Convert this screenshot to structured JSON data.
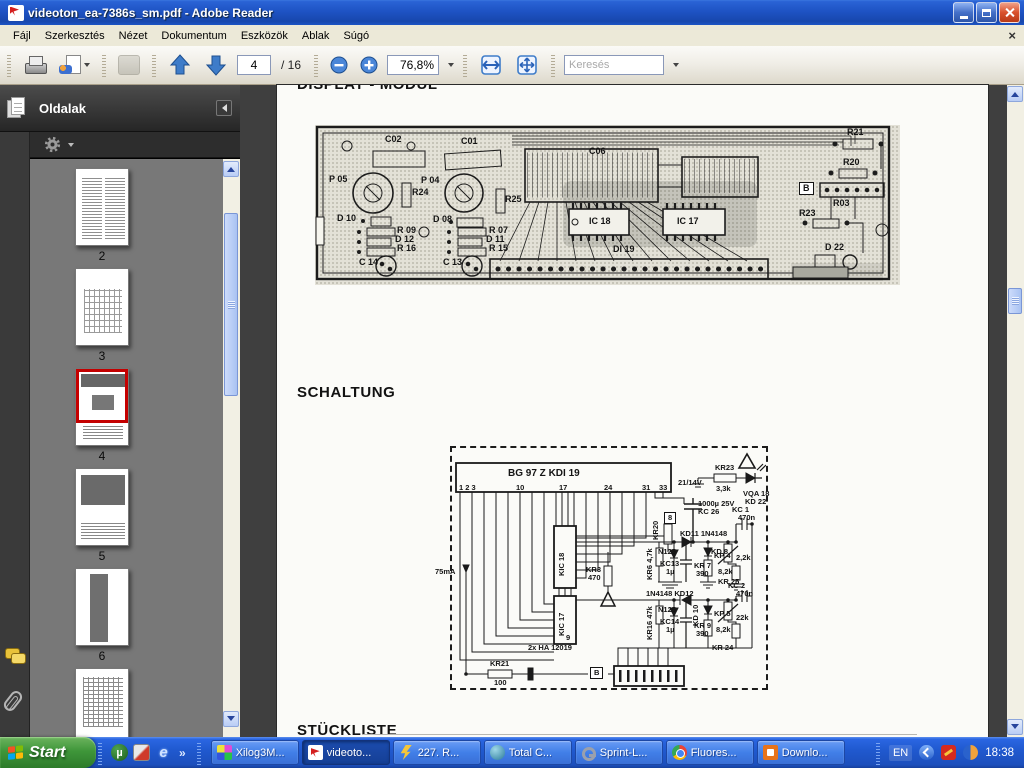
{
  "window": {
    "title": "videoton_ea-7386s_sm.pdf - Adobe Reader"
  },
  "menubar": {
    "items": [
      "Fájl",
      "Szerkesztés",
      "Nézet",
      "Dokumentum",
      "Eszközök",
      "Ablak",
      "Súgó"
    ],
    "close_label": "×"
  },
  "toolbar": {
    "page_current": "4",
    "page_total": "/ 16",
    "zoom_value": "76,8%",
    "search_placeholder": "Keresés"
  },
  "sidebar": {
    "title": "Oldalak",
    "pages": [
      {
        "label": "2",
        "kind": "text"
      },
      {
        "label": "3",
        "kind": "diagram"
      },
      {
        "label": "4",
        "kind": "pcb",
        "selected": true
      },
      {
        "label": "5",
        "kind": "schem"
      },
      {
        "label": "6",
        "kind": "tall"
      },
      {
        "label": "",
        "kind": "schem2",
        "partial": true
      }
    ]
  },
  "page": {
    "heading_top": "DISPLAY - MODUL",
    "heading_schaltung": "SCHALTUNG",
    "heading_stueckliste": "STÜCKLISTE"
  },
  "pcb": {
    "labels": [
      {
        "t": "C02",
        "x": 70,
        "y": 10
      },
      {
        "t": "C01",
        "x": 146,
        "y": 12
      },
      {
        "t": "C06",
        "x": 274,
        "y": 22
      },
      {
        "t": "P 05",
        "x": 14,
        "y": 50
      },
      {
        "t": "P 04",
        "x": 106,
        "y": 51
      },
      {
        "t": "R24",
        "x": 97,
        "y": 63
      },
      {
        "t": "R25",
        "x": 190,
        "y": 70
      },
      {
        "t": "D 10",
        "x": 22,
        "y": 89
      },
      {
        "t": "D 08",
        "x": 118,
        "y": 90
      },
      {
        "t": "R 09",
        "x": 82,
        "y": 101
      },
      {
        "t": "R 07",
        "x": 174,
        "y": 101
      },
      {
        "t": "D 12",
        "x": 80,
        "y": 110
      },
      {
        "t": "D 11",
        "x": 171,
        "y": 110
      },
      {
        "t": "R 16",
        "x": 82,
        "y": 119
      },
      {
        "t": "R 15",
        "x": 174,
        "y": 119
      },
      {
        "t": "C 14",
        "x": 44,
        "y": 133
      },
      {
        "t": "C 13",
        "x": 128,
        "y": 133
      },
      {
        "t": "IC 18",
        "x": 274,
        "y": 92
      },
      {
        "t": "IC 17",
        "x": 362,
        "y": 92
      },
      {
        "t": "DI 19",
        "x": 298,
        "y": 120
      },
      {
        "t": "R21",
        "x": 532,
        "y": 3
      },
      {
        "t": "R20",
        "x": 528,
        "y": 33
      },
      {
        "t": "R03",
        "x": 518,
        "y": 74
      },
      {
        "t": "R23",
        "x": 484,
        "y": 84
      },
      {
        "t": "D 22",
        "x": 510,
        "y": 118
      },
      {
        "t": "B",
        "x": 484,
        "y": 57,
        "box": true
      }
    ]
  },
  "schematic": {
    "labels": [
      {
        "t": "BG 97 Z   KDI 19",
        "x": 56,
        "y": 21,
        "fs": 10
      },
      {
        "t": "1 2 3",
        "x": 7,
        "y": 36
      },
      {
        "t": "10",
        "x": 64,
        "y": 36
      },
      {
        "t": "17",
        "x": 107,
        "y": 36
      },
      {
        "t": "24",
        "x": 152,
        "y": 36
      },
      {
        "t": "31",
        "x": 190,
        "y": 36
      },
      {
        "t": "33",
        "x": 207,
        "y": 36
      },
      {
        "t": "21/14V",
        "x": 226,
        "y": 31
      },
      {
        "t": "KR23",
        "x": 263,
        "y": 16
      },
      {
        "t": "3,3k",
        "x": 264,
        "y": 37
      },
      {
        "t": "VQA 18",
        "x": 291,
        "y": 42
      },
      {
        "t": "KD 22",
        "x": 293,
        "y": 50
      },
      {
        "t": "1000µ 25V",
        "x": 246,
        "y": 52
      },
      {
        "t": "KC 26",
        "x": 246,
        "y": 60
      },
      {
        "t": "KC 1",
        "x": 280,
        "y": 58
      },
      {
        "t": "470n",
        "x": 286,
        "y": 66
      },
      {
        "t": "KD11 1N4148",
        "x": 228,
        "y": 82
      },
      {
        "t": "N125",
        "x": 206,
        "y": 100
      },
      {
        "t": "KD 8",
        "x": 259,
        "y": 100
      },
      {
        "t": "KP 4",
        "x": 262,
        "y": 104
      },
      {
        "t": "2,2k",
        "x": 284,
        "y": 106
      },
      {
        "t": "KR 7",
        "x": 242,
        "y": 114
      },
      {
        "t": "390",
        "x": 244,
        "y": 122
      },
      {
        "t": "KC13",
        "x": 208,
        "y": 112
      },
      {
        "t": "1µ",
        "x": 214,
        "y": 120
      },
      {
        "t": "8,2k",
        "x": 266,
        "y": 120
      },
      {
        "t": "KR 25",
        "x": 266,
        "y": 130
      },
      {
        "t": "KR3",
        "x": 134,
        "y": 118
      },
      {
        "t": "470",
        "x": 136,
        "y": 126
      },
      {
        "t": "1N4148 KD12",
        "x": 194,
        "y": 142
      },
      {
        "t": "N125",
        "x": 206,
        "y": 158
      },
      {
        "t": "KC14",
        "x": 208,
        "y": 170
      },
      {
        "t": "1µ",
        "x": 214,
        "y": 178
      },
      {
        "t": "KR 9",
        "x": 242,
        "y": 174
      },
      {
        "t": "390",
        "x": 244,
        "y": 182
      },
      {
        "t": "KP 5",
        "x": 262,
        "y": 162
      },
      {
        "t": "22k",
        "x": 284,
        "y": 166
      },
      {
        "t": "8,2k",
        "x": 264,
        "y": 178
      },
      {
        "t": "KR 24",
        "x": 260,
        "y": 196
      },
      {
        "t": "KC 2",
        "x": 276,
        "y": 134
      },
      {
        "t": "470n",
        "x": 284,
        "y": 142
      },
      {
        "t": "2x HA 12019",
        "x": 76,
        "y": 196
      },
      {
        "t": "KR21",
        "x": 38,
        "y": 212
      },
      {
        "t": "100",
        "x": 42,
        "y": 231
      },
      {
        "t": "75mA",
        "x": -17,
        "y": 120
      },
      {
        "t": "9",
        "x": 114,
        "y": 186
      },
      {
        "t": "B",
        "x": 138,
        "y": 219,
        "box": true
      },
      {
        "t": "8",
        "x": 212,
        "y": 64,
        "box": true
      },
      {
        "t": "KIC 18",
        "x": 106,
        "y": 128,
        "r": true
      },
      {
        "t": "KIC 17",
        "x": 106,
        "y": 188,
        "r": true
      },
      {
        "t": "KR20",
        "x": 200,
        "y": 92,
        "r": true
      },
      {
        "t": "KR6 4,7k",
        "x": 194,
        "y": 132,
        "r": true
      },
      {
        "t": "KR16 47k",
        "x": 194,
        "y": 192,
        "r": true
      },
      {
        "t": "KD 10",
        "x": 240,
        "y": 178,
        "r": true
      }
    ]
  },
  "taskbar": {
    "start_label": "Start",
    "quicklaunch": [
      {
        "kind": "utorrent",
        "glyph": "µ"
      },
      {
        "kind": "app",
        "glyph": ""
      },
      {
        "kind": "ie",
        "glyph": "e"
      }
    ],
    "overflow_glyph": "»",
    "buttons": [
      {
        "label": "Xilog3M...",
        "icon": "xilog"
      },
      {
        "label": "videoto...",
        "icon": "pdf",
        "active": true
      },
      {
        "label": "227. R...",
        "icon": "flash"
      },
      {
        "label": "Total C...",
        "icon": "totalcmd"
      },
      {
        "label": "Sprint-L...",
        "icon": "key"
      },
      {
        "label": "Fluores...",
        "icon": "chrome"
      },
      {
        "label": "Downlo...",
        "icon": "download"
      }
    ],
    "tray": {
      "lang": "EN",
      "time": "18:38"
    }
  }
}
